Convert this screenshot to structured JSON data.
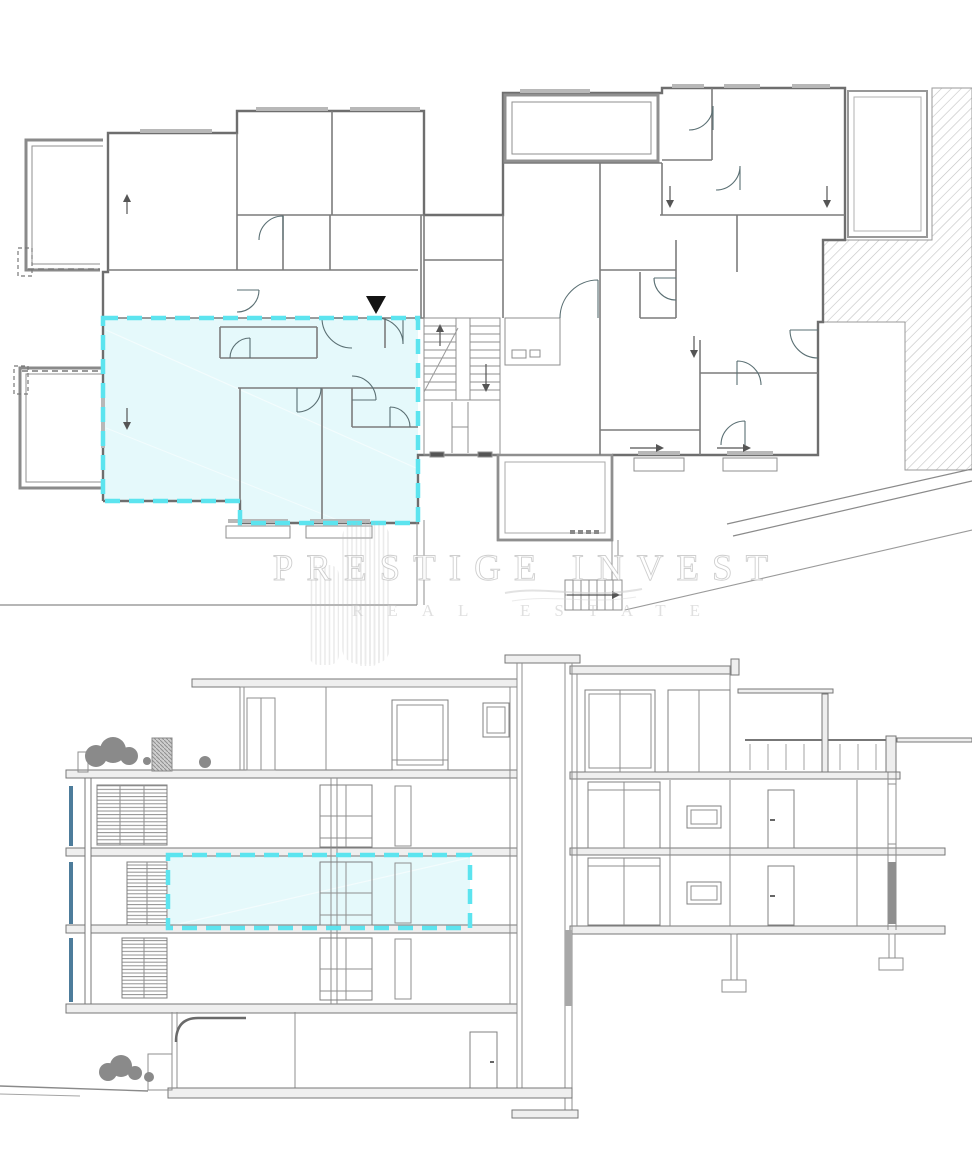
{
  "watermark": {
    "line1": "PRESTIGE INVEST",
    "line2": "REAL ESTATE"
  },
  "colors": {
    "highlight_fill": "#e0f8fa",
    "highlight_dash": "#5ce4ef",
    "line_dark": "#6e6e6e",
    "line_mid": "#8f8f8f",
    "line_light": "#b8b8b8",
    "accent_blue": "#4d7c9b",
    "vegetation": "#8a8a8a",
    "marker_black": "#141414",
    "background": "#ffffff"
  }
}
